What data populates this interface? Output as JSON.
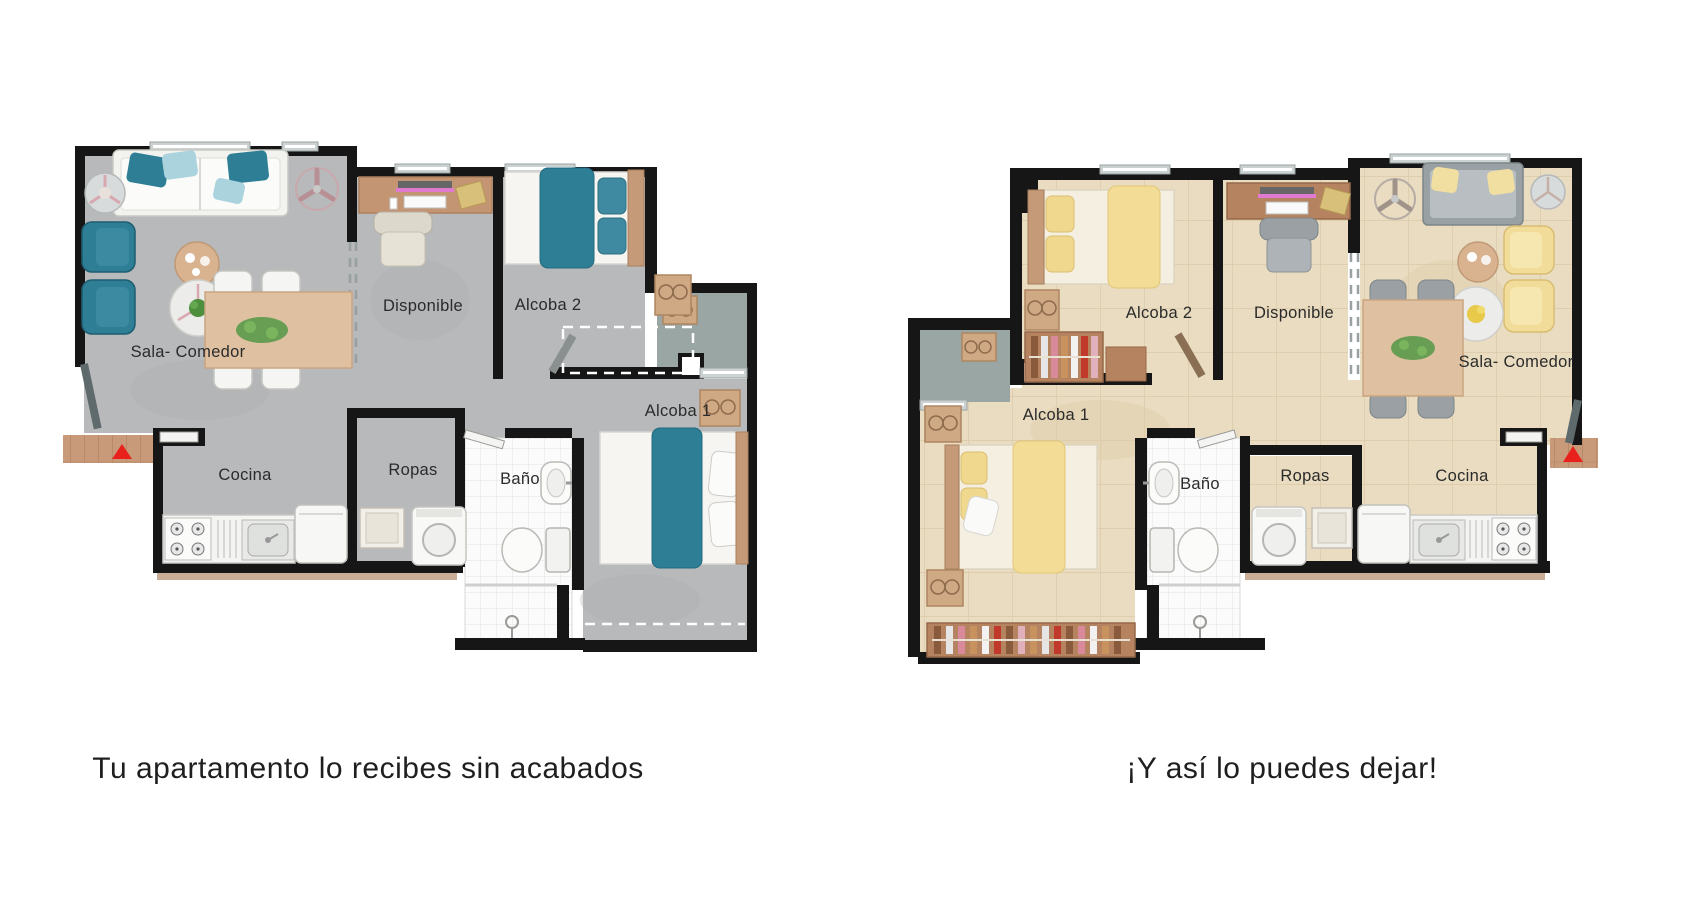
{
  "plans": [
    {
      "caption": "Tu apartamento lo recibes sin acabados",
      "style": "unfinished-gray-concrete",
      "rooms": [
        {
          "label": "Sala- Comedor"
        },
        {
          "label": "Disponible"
        },
        {
          "label": "Alcoba 2"
        },
        {
          "label": "Alcoba 1"
        },
        {
          "label": "Cocina"
        },
        {
          "label": "Ropas"
        },
        {
          "label": "Baño"
        }
      ]
    },
    {
      "caption": "¡Y así lo puedes dejar!",
      "style": "finished-beige-tile",
      "rooms": [
        {
          "label": "Sala- Comedor"
        },
        {
          "label": "Disponible"
        },
        {
          "label": "Alcoba 2"
        },
        {
          "label": "Alcoba 1"
        },
        {
          "label": "Cocina"
        },
        {
          "label": "Ropas"
        },
        {
          "label": "Baño"
        }
      ]
    }
  ],
  "colors": {
    "wall": "#161616",
    "floor_unfinished": "#b7b9ba",
    "floor_finished": "#e9dcc0",
    "accent_unfinished": "#2e7e96",
    "accent_finished": "#f2dc96",
    "wood": "#cfa884",
    "entry_arrow": "#e8211c",
    "bath_tile": "#fbfbfb",
    "text": "#2b2b2b"
  }
}
